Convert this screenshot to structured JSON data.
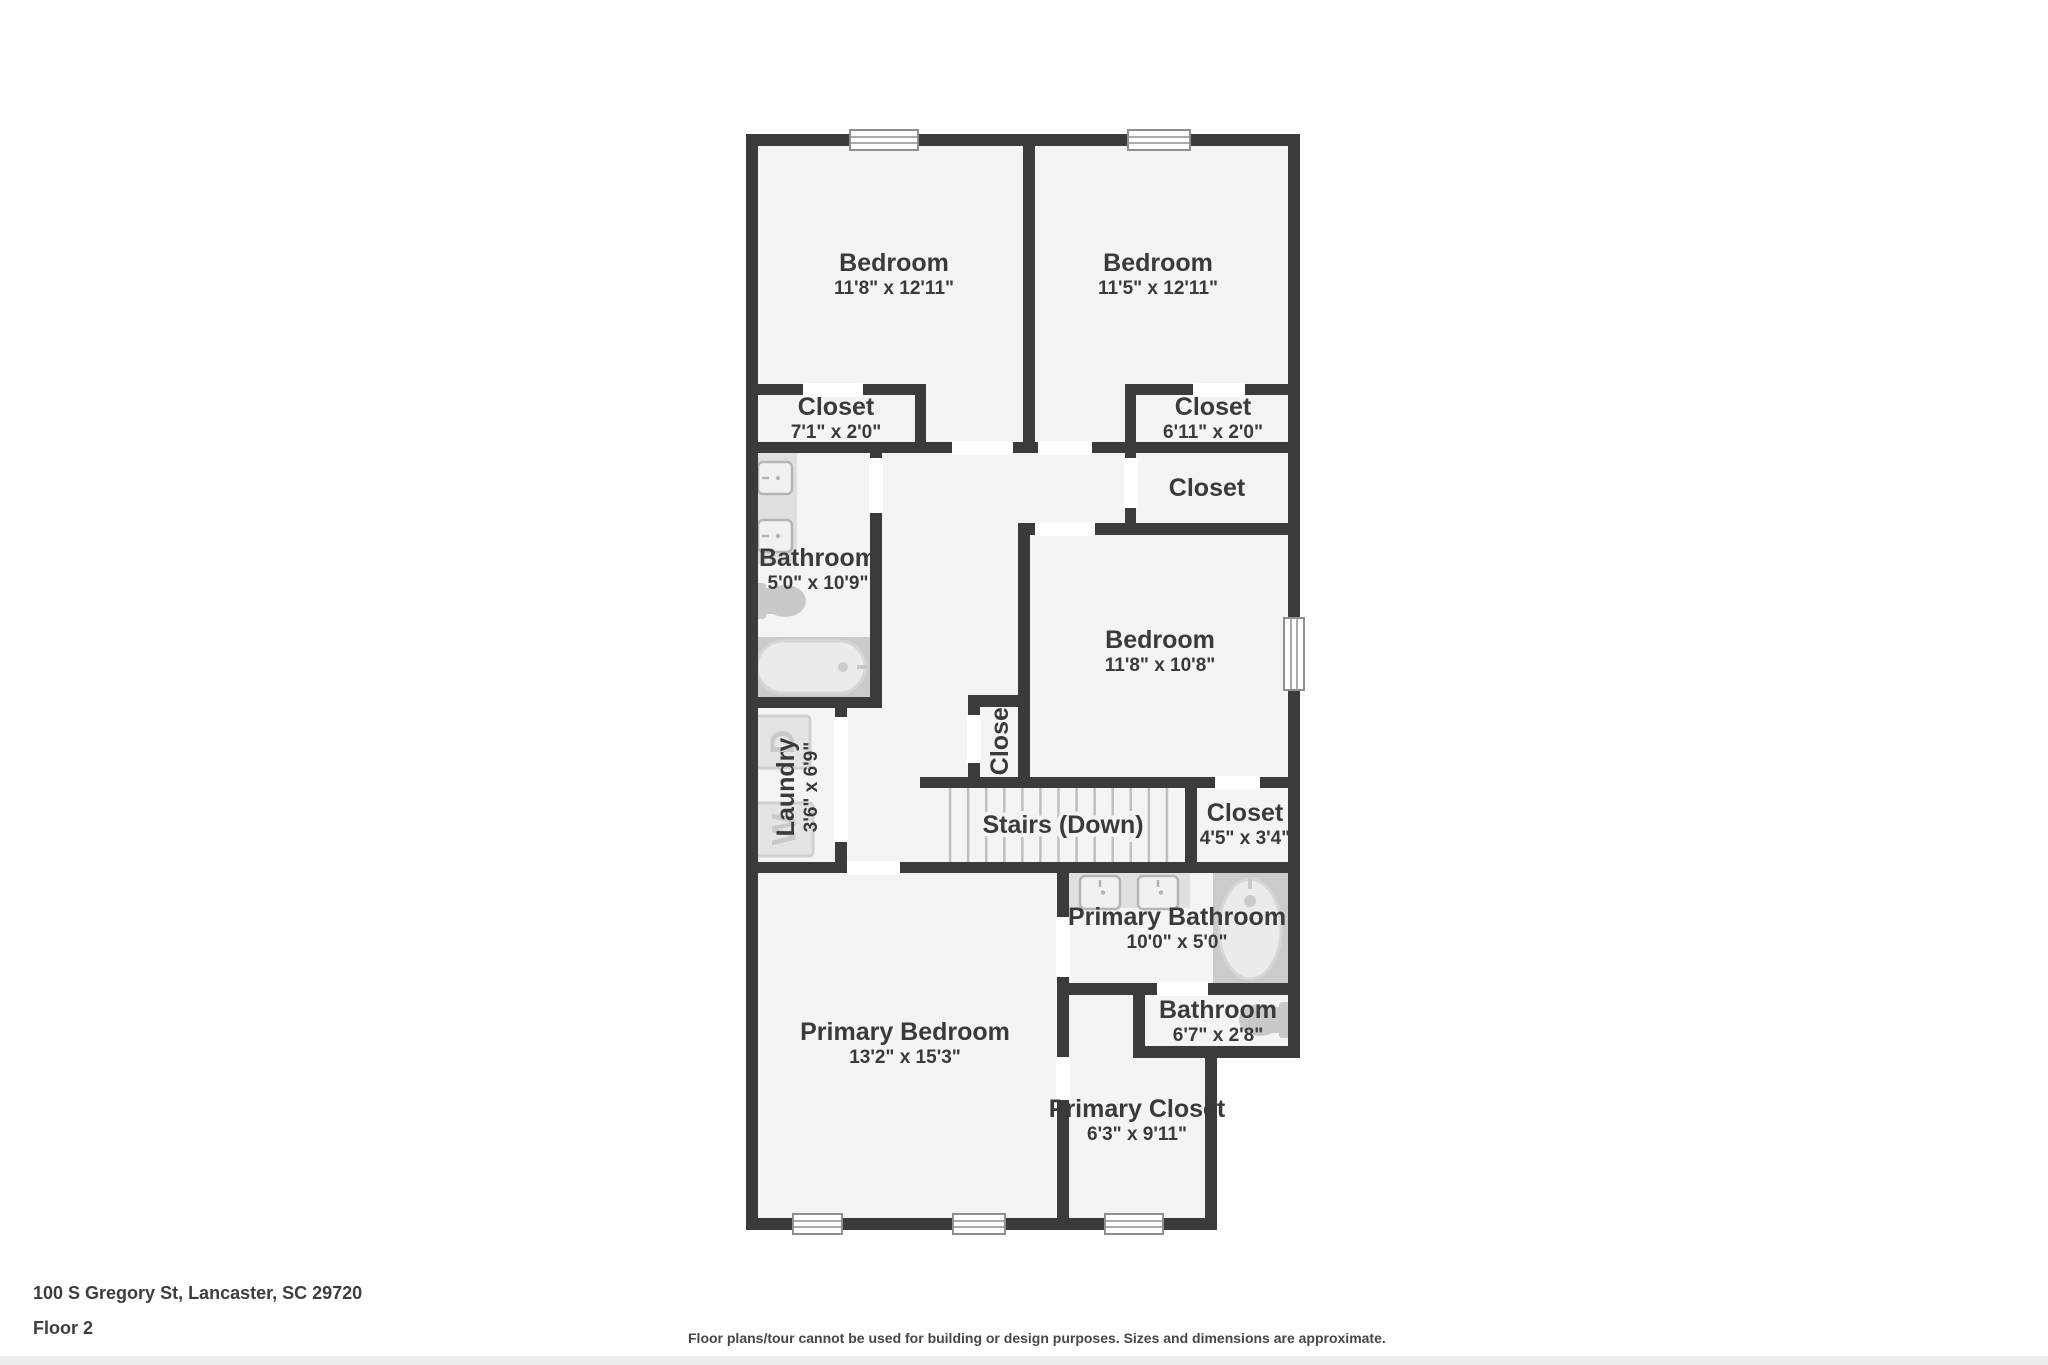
{
  "footer": {
    "address": "100 S Gregory St, Lancaster, SC 29720",
    "floor_label": "Floor 2",
    "disclaimer": "Floor plans/tour cannot be used for building or design purposes. Sizes and dimensions are approximate."
  },
  "palette": {
    "wall": "#3b3b3b",
    "floor": "#f4f4f4",
    "opening": "#ffffff",
    "label": "#3a3a3a",
    "counter": "#e0e0e0",
    "sink_fill": "#f1f1f1",
    "sink_edge": "#b5b5b5",
    "toilet": "#c9c9c9",
    "tub_surround": "#cbcbcb",
    "tub_fill": "#ebebeb",
    "tub_edge": "#d6d6d6",
    "machine_fill": "#e4e4e4",
    "machine_edge": "#d0d0d0",
    "machine_letter": "#c9c9c9",
    "tread": "#bfbfbf",
    "window_frame": "#8f8f8f"
  },
  "plan": {
    "base_rects": [
      [
        746,
        134,
        554,
        924
      ],
      [
        746,
        1058,
        471,
        172
      ]
    ],
    "walls": [
      [
        746,
        134,
        554,
        12
      ],
      [
        746,
        384,
        180,
        11
      ],
      [
        1125,
        384,
        175,
        11
      ],
      [
        746,
        442,
        554,
        11
      ],
      [
        1018,
        523,
        282,
        12
      ],
      [
        746,
        697,
        136,
        11
      ],
      [
        968,
        695,
        62,
        12
      ],
      [
        920,
        777,
        380,
        11
      ],
      [
        746,
        862,
        554,
        11
      ],
      [
        1057,
        983,
        243,
        12
      ],
      [
        1133,
        1046,
        167,
        12
      ],
      [
        746,
        1218,
        471,
        12
      ],
      [
        746,
        134,
        12,
        1096
      ],
      [
        1288,
        134,
        12,
        924
      ],
      [
        1023,
        134,
        12,
        319
      ],
      [
        915,
        384,
        11,
        69
      ],
      [
        1125,
        384,
        11,
        151
      ],
      [
        870,
        442,
        12,
        266
      ],
      [
        1018,
        523,
        12,
        265
      ],
      [
        968,
        695,
        12,
        93
      ],
      [
        835,
        708,
        12,
        165
      ],
      [
        1185,
        777,
        12,
        96
      ],
      [
        1057,
        873,
        12,
        345
      ],
      [
        1133,
        983,
        12,
        75
      ],
      [
        1205,
        1046,
        12,
        184
      ]
    ],
    "doors": [
      [
        803,
        383,
        60,
        14
      ],
      [
        952,
        441,
        61,
        14
      ],
      [
        1038,
        441,
        54,
        14
      ],
      [
        1193,
        383,
        52,
        14
      ],
      [
        1124,
        458,
        14,
        50
      ],
      [
        869,
        458,
        14,
        55
      ],
      [
        1035,
        522,
        60,
        14
      ],
      [
        967,
        715,
        14,
        48
      ],
      [
        834,
        717,
        14,
        125
      ],
      [
        1215,
        776,
        45,
        14
      ],
      [
        847,
        861,
        53,
        14
      ],
      [
        1056,
        917,
        14,
        60
      ],
      [
        1056,
        1057,
        14,
        43
      ],
      [
        1157,
        982,
        51,
        14
      ]
    ],
    "windows": [
      [
        850,
        130,
        68,
        20
      ],
      [
        1128,
        130,
        62,
        20
      ],
      [
        1284,
        618,
        20,
        72
      ],
      [
        793,
        1214,
        49,
        20
      ],
      [
        953,
        1214,
        52,
        20
      ],
      [
        1105,
        1214,
        58,
        20
      ]
    ],
    "stairs": {
      "x": 932,
      "y": 788,
      "w": 253,
      "h": 74,
      "treads": 13
    },
    "counters": [
      {
        "x": 753,
        "y": 452,
        "w": 44,
        "h": 112
      },
      {
        "x": 1069,
        "y": 873,
        "w": 121,
        "h": 35
      }
    ],
    "sinks": [
      {
        "x": 758,
        "y": 462,
        "w": 34,
        "h": 32,
        "side": "left"
      },
      {
        "x": 758,
        "y": 520,
        "w": 34,
        "h": 32,
        "side": "left"
      },
      {
        "x": 1080,
        "y": 876,
        "w": 40,
        "h": 33,
        "side": "top"
      },
      {
        "x": 1138,
        "y": 876,
        "w": 40,
        "h": 33,
        "side": "top"
      }
    ],
    "toilets": [
      {
        "cx": 781,
        "cy": 601,
        "dir": "right"
      },
      {
        "cx": 1264,
        "cy": 1020,
        "dir": "left"
      }
    ],
    "tub": {
      "surround": [
        753,
        637,
        124,
        60
      ],
      "tub": [
        757,
        641,
        108,
        52
      ],
      "drain": [
        843,
        667
      ],
      "faucet": [
        857,
        867,
        667
      ]
    },
    "shower": {
      "surround": [
        1213,
        873,
        75,
        110
      ],
      "cx": 1250,
      "cy": 929,
      "rx": 31,
      "ry": 50,
      "drain": [
        1250,
        901
      ]
    },
    "machines": [
      {
        "x": 756,
        "y": 716,
        "w": 54,
        "h": 52,
        "letter": "D"
      },
      {
        "x": 756,
        "y": 803,
        "w": 57,
        "h": 53,
        "letter": "W"
      }
    ],
    "rooms": [
      {
        "name": "Bedroom",
        "dims": "11'8\" x 12'11\"",
        "cx": 894,
        "cy": 271,
        "rotate": 0
      },
      {
        "name": "Bedroom",
        "dims": "11'5\" x 12'11\"",
        "cx": 1158,
        "cy": 271,
        "rotate": 0
      },
      {
        "name": "Closet",
        "dims": "7'1\" x 2'0\"",
        "cx": 836,
        "cy": 415,
        "rotate": 0
      },
      {
        "name": "Closet",
        "dims": "6'11\" x 2'0\"",
        "cx": 1213,
        "cy": 415,
        "rotate": 0
      },
      {
        "name": "Closet",
        "dims": "",
        "cx": 1207,
        "cy": 487,
        "rotate": 0
      },
      {
        "name": "Bathroom",
        "dims": "5'0\" x 10'9\"",
        "cx": 818,
        "cy": 566,
        "rotate": 0
      },
      {
        "name": "Bedroom",
        "dims": "11'8\" x 10'8\"",
        "cx": 1160,
        "cy": 648,
        "rotate": 0
      },
      {
        "name": "Closet",
        "dims": "",
        "cx": 999,
        "cy": 737,
        "rotate": -90
      },
      {
        "name": "Laundry",
        "dims": "3'6\" x 6'9\"",
        "cx": 794,
        "cy": 787,
        "rotate": -90
      },
      {
        "name": "Stairs (Down)",
        "dims": "",
        "cx": 1063,
        "cy": 824,
        "rotate": 0,
        "halo": true
      },
      {
        "name": "Closet",
        "dims": "4'5\" x 3'4\"",
        "cx": 1245,
        "cy": 821,
        "rotate": 0
      },
      {
        "name": "Primary Bathroom",
        "dims": "10'0\" x 5'0\"",
        "cx": 1177,
        "cy": 925,
        "rotate": 0
      },
      {
        "name": "Bathroom",
        "dims": "6'7\" x 2'8\"",
        "cx": 1218,
        "cy": 1018,
        "rotate": 0
      },
      {
        "name": "Primary Bedroom",
        "dims": "13'2\" x 15'3\"",
        "cx": 905,
        "cy": 1040,
        "rotate": 0
      },
      {
        "name": "Primary Closet",
        "dims": "6'3\" x 9'11\"",
        "cx": 1137,
        "cy": 1117,
        "rotate": 0
      }
    ]
  }
}
